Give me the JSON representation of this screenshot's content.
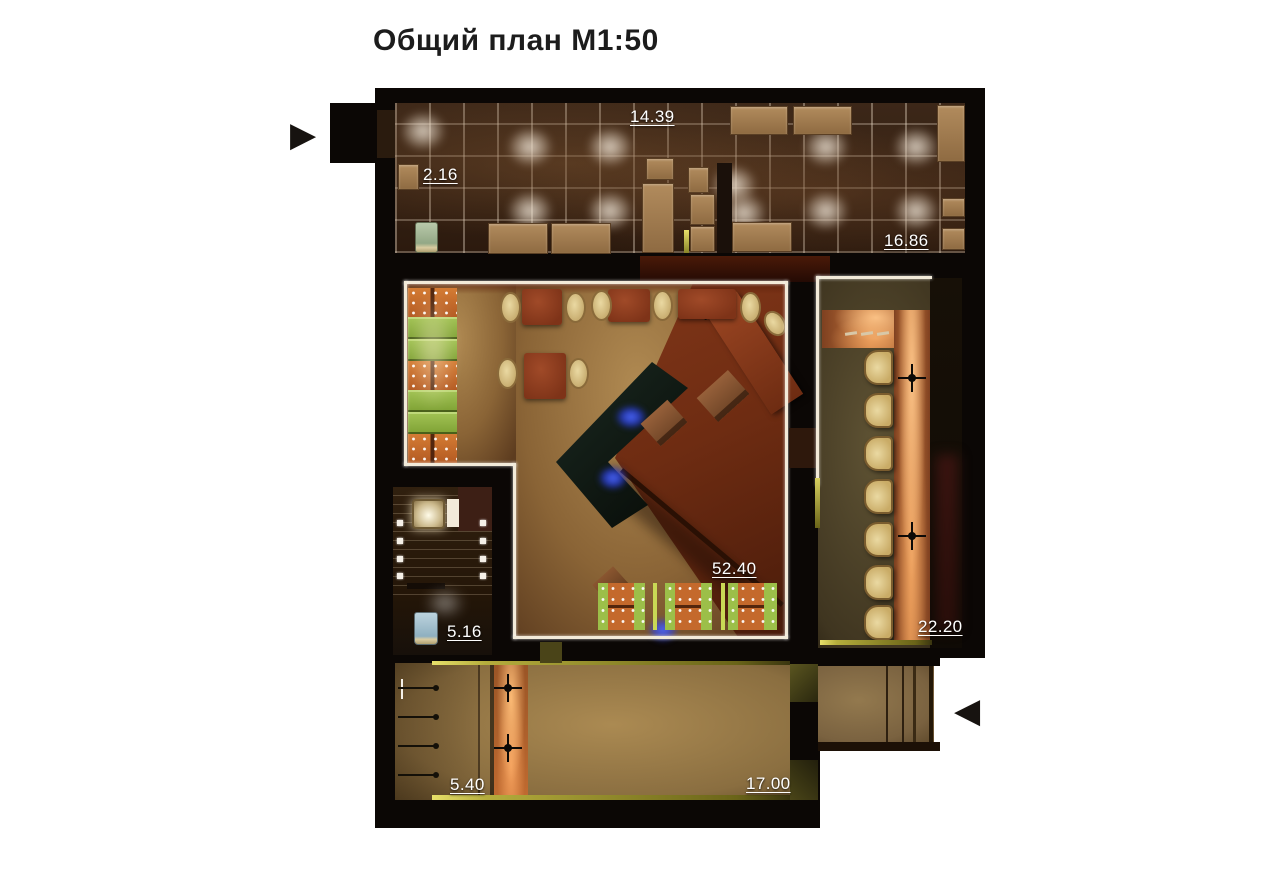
{
  "title": "Общий план М1:50",
  "labels": [
    {
      "room": "kitchen-left",
      "value": "14.39"
    },
    {
      "room": "storage",
      "value": "2.16"
    },
    {
      "room": "kitchen-right",
      "value": "16.86"
    },
    {
      "room": "dining-hall",
      "value": "52.40"
    },
    {
      "room": "wc",
      "value": "5.16"
    },
    {
      "room": "bar-lounge",
      "value": "22.20"
    },
    {
      "room": "wardrobe",
      "value": "5.40"
    },
    {
      "room": "corridor",
      "value": "17.00"
    }
  ],
  "icons": {
    "entrance_arrow": "▶",
    "exit_arrow": "◀"
  },
  "colors": {
    "wall": "#0b0705",
    "kitchen_floor": "#40291a",
    "tan_floor": "#a07c4c",
    "red_floor": "#6e2c12",
    "booth_green": "#8fb33f",
    "booth_orange": "#c4692c",
    "bar_counter_glow": "#d8864a",
    "bar_floor": "#4a3f26",
    "stool_cream": "#d9c489",
    "blue_accent": "#2a3fe8",
    "trim_white": "#f2ead9",
    "trim_yellow": "#b5ad3c",
    "label_white": "#ffffff",
    "title_black": "#1c1c1c"
  }
}
